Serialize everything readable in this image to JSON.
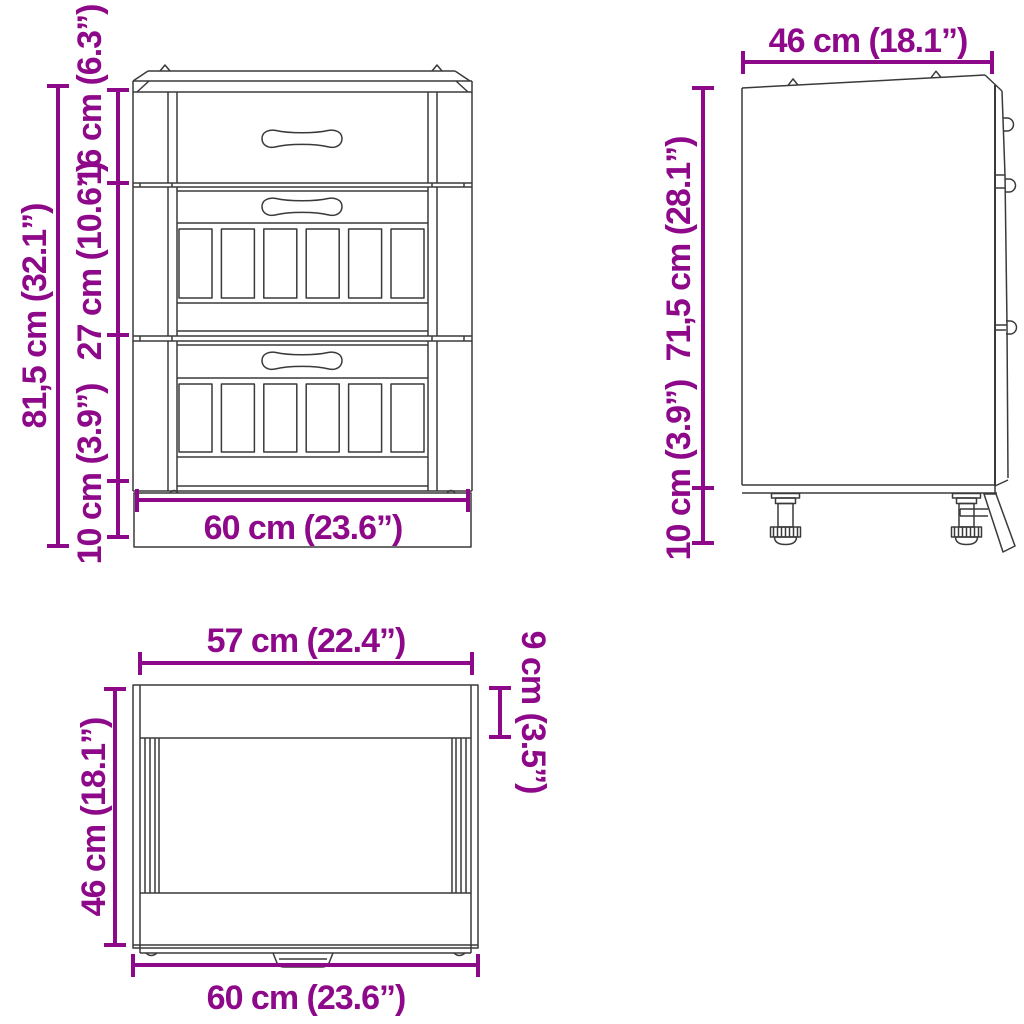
{
  "palette": {
    "dimension_color": "#8E0989",
    "line_color": "#3A3A3A",
    "background": "#FFFFFF"
  },
  "diagram": {
    "type": "furniture-dimension-drawing",
    "subject": "kitchen base cabinet with 3 drawers"
  },
  "front_view": {
    "dimensions": {
      "total_height": "81,5 cm (32.1”)",
      "top_drawer_height": "16 cm (6.3”)",
      "middle_drawer_height": "27 cm (10.6”)",
      "plinth_height": "10 cm (3.9”)",
      "width": "60 cm (23.6”)"
    }
  },
  "side_view": {
    "dimensions": {
      "depth": "46 cm (18.1”)",
      "body_height": "71,5 cm (28.1”)",
      "leg_height": "10 cm (3.9”)"
    }
  },
  "top_view": {
    "dimensions": {
      "carcass_width": "57 cm (22.4”)",
      "depth": "46 cm (18.1”)",
      "front_rail_depth": "9 cm (3.5”)",
      "total_width": "60 cm (23.6”)"
    }
  }
}
